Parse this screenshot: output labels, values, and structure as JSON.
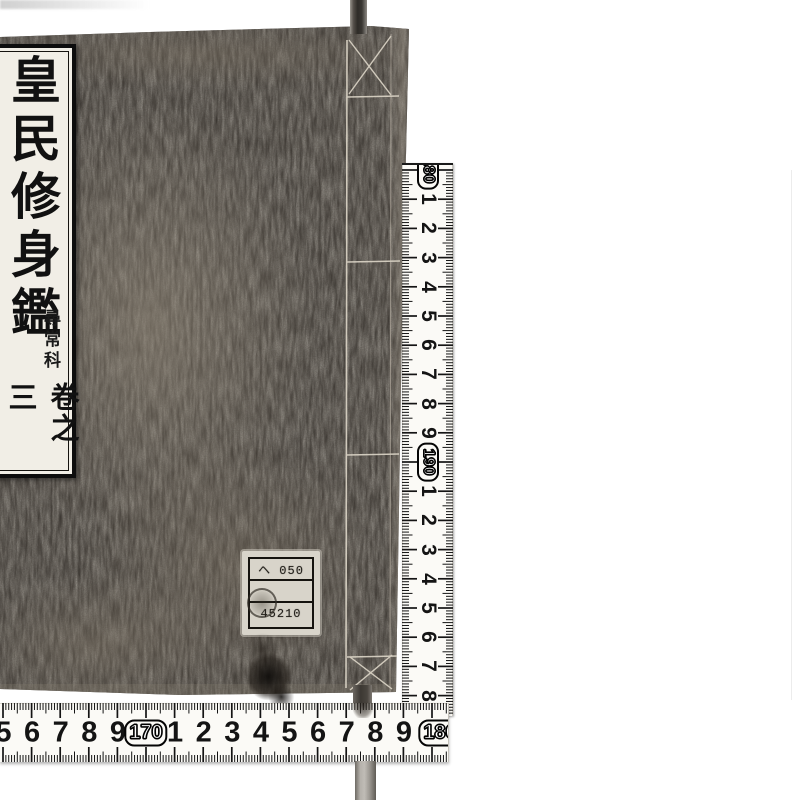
{
  "scene": {
    "background": "#ffffff",
    "book_cover_color": "#332f2b",
    "ruler_paper_color": "#fbfaf6",
    "tick_color": "#141414",
    "thread_color": "#ddd6c8"
  },
  "book": {
    "title_label": {
      "title": "皇民修身鑑",
      "course": "尋常科",
      "volume": "卷之三"
    },
    "sticker": {
      "row1": "ヘ 050",
      "row2": "",
      "row3": "45210"
    }
  },
  "vertical_ruler": {
    "marks": [
      {
        "type": "decade",
        "label": "180"
      },
      {
        "type": "cm",
        "label": "1"
      },
      {
        "type": "cm",
        "label": "2"
      },
      {
        "type": "cm",
        "label": "3"
      },
      {
        "type": "cm",
        "label": "4"
      },
      {
        "type": "cm",
        "label": "5"
      },
      {
        "type": "cm",
        "label": "6"
      },
      {
        "type": "cm",
        "label": "7"
      },
      {
        "type": "cm",
        "label": "8"
      },
      {
        "type": "cm",
        "label": "9"
      },
      {
        "type": "decade",
        "label": "190"
      },
      {
        "type": "cm",
        "label": "1"
      },
      {
        "type": "cm",
        "label": "2"
      },
      {
        "type": "cm",
        "label": "3"
      },
      {
        "type": "cm",
        "label": "4"
      },
      {
        "type": "cm",
        "label": "5"
      },
      {
        "type": "cm",
        "label": "6"
      },
      {
        "type": "cm",
        "label": "7"
      },
      {
        "type": "cm",
        "label": "8"
      }
    ]
  },
  "horizontal_ruler": {
    "marks": [
      {
        "type": "cm",
        "label": "5"
      },
      {
        "type": "cm",
        "label": "6"
      },
      {
        "type": "cm",
        "label": "7"
      },
      {
        "type": "cm",
        "label": "8"
      },
      {
        "type": "cm",
        "label": "9"
      },
      {
        "type": "decade",
        "label": "170"
      },
      {
        "type": "cm",
        "label": "1"
      },
      {
        "type": "cm",
        "label": "2"
      },
      {
        "type": "cm",
        "label": "3"
      },
      {
        "type": "cm",
        "label": "4"
      },
      {
        "type": "cm",
        "label": "5"
      },
      {
        "type": "cm",
        "label": "6"
      },
      {
        "type": "cm",
        "label": "7"
      },
      {
        "type": "cm",
        "label": "8"
      },
      {
        "type": "cm",
        "label": "9"
      },
      {
        "type": "decade",
        "label": "180"
      }
    ]
  }
}
